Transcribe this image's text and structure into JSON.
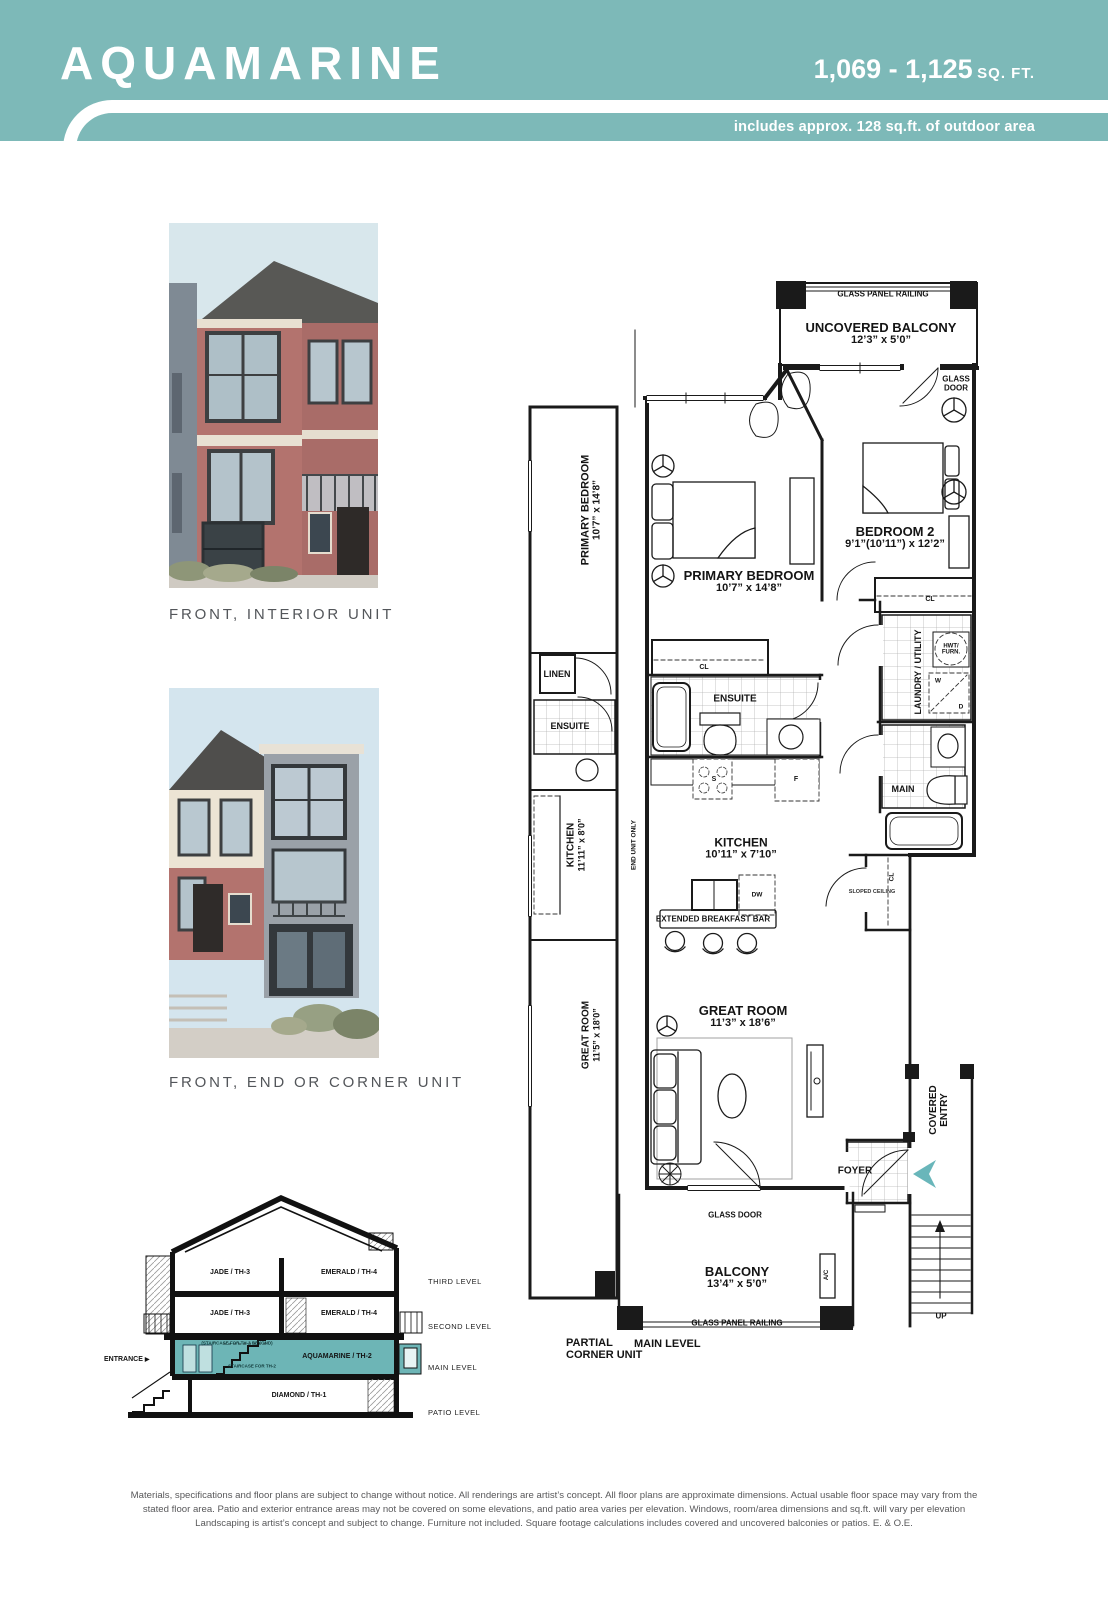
{
  "header": {
    "teal": "#7db9b8",
    "title": "AQUAMARINE",
    "sqft_range": "1,069 - 1,125",
    "sqft_unit": "SQ. FT.",
    "outdoor_note": "includes approx. 128 sq.ft. of outdoor area"
  },
  "renderings": {
    "front_interior_caption": "FRONT, INTERIOR UNIT",
    "front_end_caption": "FRONT, END OR CORNER UNIT"
  },
  "plan": {
    "arrow_color": "#69b6ba",
    "glass_panel_railing_top": "GLASS PANEL RAILING",
    "uncovered_balcony_name": "UNCOVERED BALCONY",
    "uncovered_balcony_dims": "12’3” x 5’0”",
    "glass_door_top_1": "GLASS",
    "glass_door_top_2": "DOOR",
    "strip_primary_name": "PRIMARY BEDROOM",
    "strip_primary_dims": "10’7” x 14’8”",
    "linen": "LINEN",
    "ensuite_left": "ENSUITE",
    "strip_kitchen_name": "KITCHEN",
    "strip_kitchen_dims": "11’11” x 8’0”",
    "end_unit_only": "END UNIT ONLY",
    "strip_great_name": "GREAT ROOM",
    "strip_great_dims": "11’5” x 18’0”",
    "primary_name": "PRIMARY BEDROOM",
    "primary_dims": "10’7” x 14’8”",
    "bedroom2_name": "BEDROOM 2",
    "bedroom2_dims": "9’1”(10’11”) x 12’2”",
    "cl_primary": "CL",
    "cl_bedroom2": "CL",
    "ensuite_main": "ENSUITE",
    "laundry_utility": "LAUNDRY / UTILITY",
    "hwt_1": "HWT/",
    "hwt_2": "FURN.",
    "washer": "W",
    "dryer": "D",
    "main_bath": "MAIN",
    "kitchen_name": "KITCHEN",
    "kitchen_dims": "10’11” x 7’10”",
    "stove": "S",
    "fridge": "F",
    "dishwasher": "DW",
    "breakfast_bar": "EXTENDED BREAKFAST BAR",
    "cl_hall": "CL",
    "sloped_ceiling": "SLOPED CEILING",
    "great_name": "GREAT ROOM",
    "great_dims": "11’3” x 18’6”",
    "foyer": "FOYER",
    "covered_entry_1": "COVERED",
    "covered_entry_2": "ENTRY",
    "glass_door_bottom": "GLASS DOOR",
    "balcony_name": "BALCONY",
    "balcony_dims": "13’4” x 5’0”",
    "ac": "A/C",
    "glass_panel_railing_bottom": "GLASS PANEL RAILING",
    "up": "UP",
    "partial_corner_1": "PARTIAL",
    "partial_corner_2": "CORNER UNIT",
    "main_level": "MAIN LEVEL"
  },
  "section": {
    "teal": "#6db5b6",
    "third_left": "JADE / TH-3",
    "third_right": "EMERALD / TH-4",
    "second_left": "JADE / TH-3",
    "second_right": "EMERALD / TH-4",
    "main_band": "AQUAMARINE / TH-2",
    "patio": "DIAMOND / TH-1",
    "entrance": "ENTRANCE",
    "note_upper": "(STAIRCASE FOR TH-3 BEYOND)",
    "note_lower": "STAIRCASE FOR TH-2",
    "levels": {
      "third": "THIRD LEVEL",
      "second": "SECOND LEVEL",
      "main": "MAIN LEVEL",
      "patio": "PATIO LEVEL"
    }
  },
  "disclaimer": {
    "line1": "Materials, specifications and floor plans are subject to change without notice. All renderings are artist’s concept. All floor plans are approximate dimensions. Actual usable floor space may vary from the",
    "line2": "stated floor area. Patio and exterior entrance areas may not be covered on some elevations, and patio area varies per elevation. Windows, room/area dimensions and sq.ft. will vary per elevation",
    "line3": "Landscaping is artist’s concept and subject to change. Furniture not included. Square footage calculations includes covered and uncovered balconies or patios. E. & O.E."
  }
}
